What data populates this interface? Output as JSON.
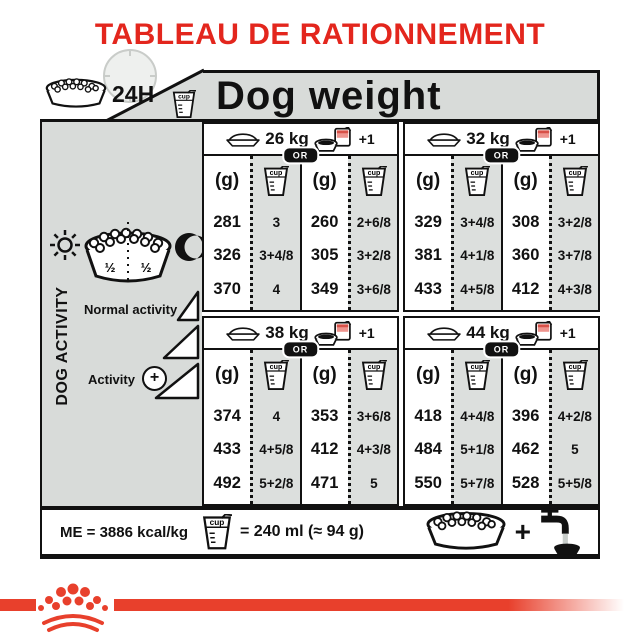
{
  "title": "TABLEAU DE RATIONNEMENT",
  "header": {
    "duration_label": "24H",
    "dog_weight_label": "Dog weight",
    "cup_icon_label": "cup"
  },
  "sidebar": {
    "title": "DOG ACTIVITY",
    "bowl_half_left": "½",
    "bowl_half_right": "½",
    "normal_activity_label": "Normal activity",
    "activity_label": "Activity",
    "activity_plus": "+"
  },
  "table": {
    "gram_unit": "(g)",
    "or_label": "OR",
    "extra_label": "+1",
    "sections": [
      {
        "weight": "26 kg",
        "columns": [
          {
            "grams": [
              "281",
              "326",
              "370"
            ],
            "cups": [
              "3",
              "3+4/8",
              "4"
            ]
          },
          {
            "grams": [
              "260",
              "305",
              "349"
            ],
            "cups": [
              "2+6/8",
              "3+2/8",
              "3+6/8"
            ]
          }
        ]
      },
      {
        "weight": "32 kg",
        "columns": [
          {
            "grams": [
              "329",
              "381",
              "433"
            ],
            "cups": [
              "3+4/8",
              "4+1/8",
              "4+5/8"
            ]
          },
          {
            "grams": [
              "308",
              "360",
              "412"
            ],
            "cups": [
              "3+2/8",
              "3+7/8",
              "4+3/8"
            ]
          }
        ]
      },
      {
        "weight": "38 kg",
        "columns": [
          {
            "grams": [
              "374",
              "433",
              "492"
            ],
            "cups": [
              "4",
              "4+5/8",
              "5+2/8"
            ]
          },
          {
            "grams": [
              "353",
              "412",
              "471"
            ],
            "cups": [
              "3+6/8",
              "4+3/8",
              "5"
            ]
          }
        ]
      },
      {
        "weight": "44 kg",
        "columns": [
          {
            "grams": [
              "418",
              "484",
              "550"
            ],
            "cups": [
              "4+4/8",
              "5+1/8",
              "5+7/8"
            ]
          },
          {
            "grams": [
              "396",
              "462",
              "528"
            ],
            "cups": [
              "4+2/8",
              "5",
              "5+5/8"
            ]
          }
        ]
      }
    ]
  },
  "footer": {
    "energy_label": "ME = 3886 kcal/kg",
    "cup_equivalence": "= 240 ml (≈ 94 g)",
    "plus_sign": "+"
  },
  "colors": {
    "accent_red": "#e3261d",
    "band_red": "#e8402c",
    "header_gray": "#d8dbd9",
    "cup_column_gray": "#dcdfdd"
  }
}
